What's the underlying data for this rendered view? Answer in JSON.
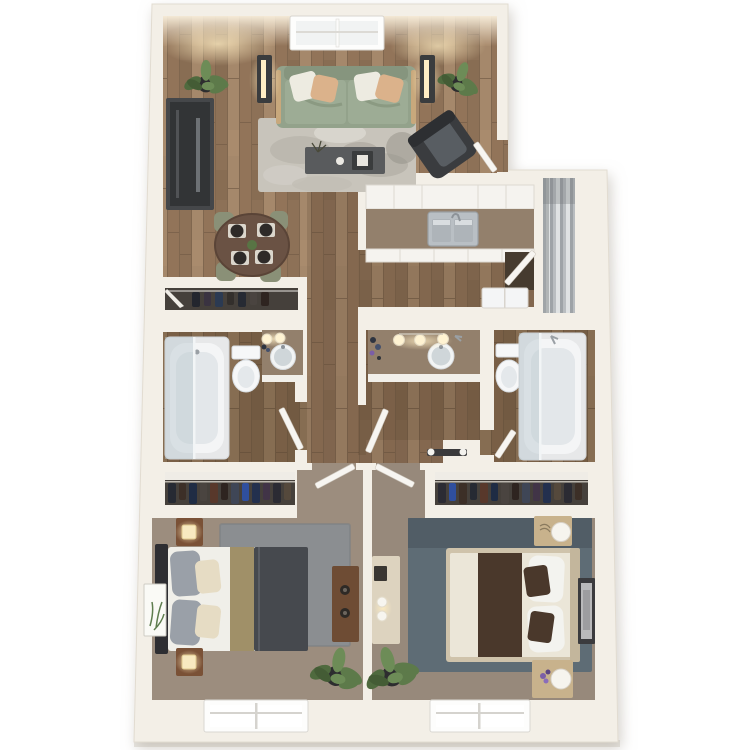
{
  "meta": {
    "type": "3d-rendered-floor-plan",
    "description": "Top-down 3D apartment floor plan, two bedrooms and two bathrooms, no visible text labels",
    "canvas": {
      "width": 750,
      "height": 750
    }
  },
  "palette": {
    "background": "#ffffff",
    "wall": "#f3efe7",
    "wall_edge": "#e0dacd",
    "slab_edge": "#e9e7e2",
    "wood_base": "#9a7d61",
    "wood_dark_overlay": "#3f2d1c",
    "carpet_bed1": "#9c8d7e",
    "carpet_bed2": "#97897b",
    "rug_living": "#c8c4bb",
    "rug_bed1": "#8b8e91",
    "rug_bed2": "#5e6c75",
    "sofa": "#93a28b",
    "sofa_seat": "#9dac95",
    "sofa_frame": "#c8a87c",
    "pillow_white": "#edebe1",
    "pillow_tan": "#dbb28b",
    "armchair": "#3a3c3f",
    "armchair_cushion": "#585d62",
    "tv_console": "#45474a",
    "coffee_table": "#595b5d",
    "dining_table": "#6a5244",
    "chair_sage": "#8a9077",
    "plate_dark": "#2e2a28",
    "lamp_body": "#3a3c3e",
    "lamp_glow": "#ffeec4",
    "plant_green": "#5d7a4a",
    "plant_pot": "#2d2d2f",
    "cabinet_white": "#f5f3ef",
    "counter_brown": "#93806c",
    "steel": "#b9bfc4",
    "fixture_white": "#f4f5f6",
    "glass": "#b9c7ce",
    "louver_gray": "#b9bdc0",
    "doorway_dark": "#463b2f",
    "door_white": "#f7f5f1",
    "closet_dark": "#45403b",
    "closet_shelf": "#efece6",
    "bed1_headboard": "#2e2e32",
    "bed1_sheet": "#f0efe9",
    "bed1_pillow_gray": "#9aa0a8",
    "bed1_pillow_cream": "#e6dcc4",
    "bed1_runner": "#a09068",
    "bed1_comforter": "#46494e",
    "nightstand1_wood": "#7a5136",
    "dresser1_wood": "#6e4c34",
    "bed2_frame": "#cfc3ab",
    "bed2_bedding": "#ebe6d8",
    "bed2_runner": "#4a382b",
    "nightstand2_wood": "#c8b28c",
    "dresser2_cream": "#ddd3bf",
    "artwork_canvas": "#fafaf6",
    "artwork_frame_dark": "#3b3b3e",
    "accent_purple": "#7b5ea7",
    "window_white": "#fdfdfc",
    "window_glass": "#f1f3f3"
  },
  "rooms": [
    {
      "id": "living-room",
      "name": "Living Room",
      "furniture": [
        "picture window",
        "sofa with 4 accent pillows",
        "floor lamp (x2, lit)",
        "potted plant (x2)",
        "media console",
        "mottled area rug",
        "coffee table with tray and decor",
        "accent armchair",
        "entry door"
      ]
    },
    {
      "id": "dining-area",
      "name": "Dining Area",
      "furniture": [
        "round dining table",
        "place setting (x4)",
        "sage dining chair (x4)",
        "centerpiece plant",
        "coat closet"
      ]
    },
    {
      "id": "kitchen",
      "name": "Kitchen",
      "furniture": [
        "upper cabinet run",
        "brown countertop",
        "double stainless sink with faucet",
        "lower cabinet run",
        "white appliance",
        "utility doorway with door",
        "louvered utility closet"
      ]
    },
    {
      "id": "hallway",
      "name": "Hallway",
      "furniture": []
    },
    {
      "id": "bathroom-1",
      "name": "Bathroom 1",
      "furniture": [
        "tub with glass shower panel",
        "toilet",
        "vanity with round sink",
        "mirror light bulbs (x2)",
        "toiletry bottles",
        "swing door"
      ]
    },
    {
      "id": "vanity-area",
      "name": "Vanity / Dressing Area",
      "furniture": [
        "long vanity counter",
        "round sink",
        "mirror light bulbs (x3)",
        "toiletry bottles",
        "towel bar",
        "swing door"
      ]
    },
    {
      "id": "bathroom-2",
      "name": "Bathroom 2",
      "furniture": [
        "tub with glass shower panel",
        "toilet",
        "swing door"
      ]
    },
    {
      "id": "bedroom-1",
      "name": "Bedroom 1 (left)",
      "furniture": [
        "reach-in closet with hanging clothes",
        "queen bed: gray comforter, olive runner, gray + cream pillows",
        "nightstand with lit lamp (x2)",
        "leaning canvas artwork",
        "dresser with round pulls",
        "gray rug",
        "potted plant",
        "window"
      ]
    },
    {
      "id": "bedroom-2",
      "name": "Bedroom 2 (right)",
      "furniture": [
        "reach-in closet with hanging clothes",
        "queen bed: cream bedding, dark brown runner and accent pillows",
        "light-wood nightstand with white lamp (x2)",
        "framed wall art",
        "cream dresser with decor",
        "slate blue rug",
        "potted plant",
        "window"
      ]
    }
  ],
  "counts": {
    "bedrooms": 2,
    "bathrooms": 2,
    "closets": 3,
    "windows_bottom": 2,
    "window_top": 1,
    "plants": 6,
    "doors": 7
  }
}
